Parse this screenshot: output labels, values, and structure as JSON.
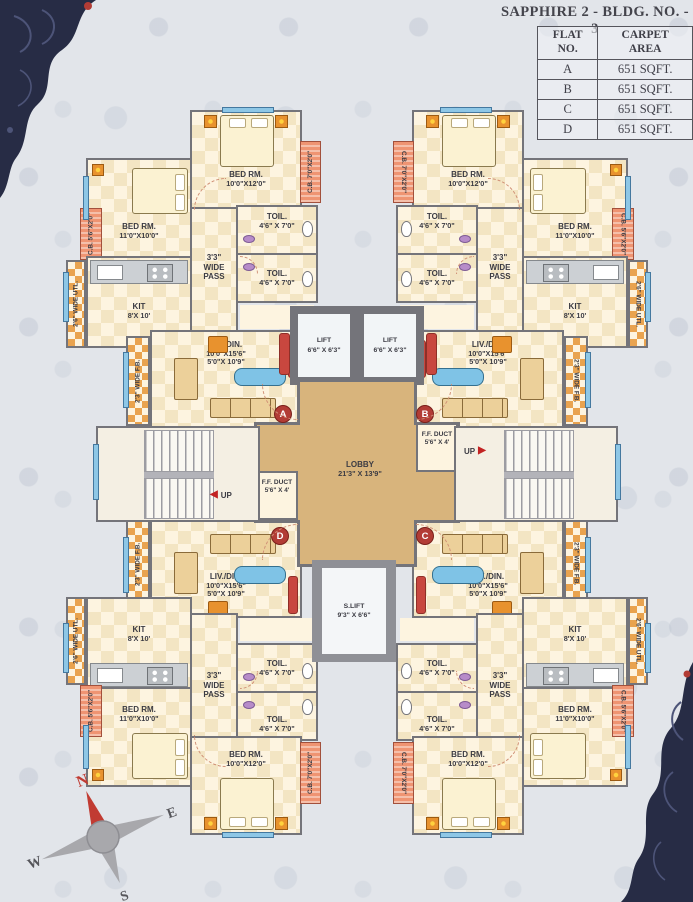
{
  "title": "SAPPHIRE 2 - BLDG. NO. - 3",
  "area_table": {
    "col1_header": "FLAT NO.",
    "col2_header": "CARPET AREA",
    "rows": [
      {
        "flat": "A",
        "area": "651 SQFT."
      },
      {
        "flat": "B",
        "area": "651 SQFT."
      },
      {
        "flat": "C",
        "area": "651 SQFT."
      },
      {
        "flat": "D",
        "area": "651 SQFT."
      }
    ]
  },
  "unit": {
    "bed_top": {
      "name": "BED RM.",
      "dims": "10'0\"X12'0\""
    },
    "bed_side": {
      "name": "BED RM.",
      "dims": "11'0\"X10'0\""
    },
    "kitchen": {
      "name": "KIT",
      "dims": "8'X 10'"
    },
    "toilet": {
      "name": "TOIL.",
      "dims": "4'6\" X 7'0\""
    },
    "living": {
      "name": "LIV./DIN.",
      "dims1": "10'0\"X15'6\"",
      "dims2": "5'0\"X 10'9\""
    },
    "pass": "3'3\" WIDE PASS",
    "flower_bed": "2'3\" WIDE F.B.",
    "utility": "2'6\" WIDE UTL.",
    "cb_side": "C.B. 5'6\"X2'0\"",
    "cb_top": "C.B. 7'0\"X2'0\""
  },
  "core": {
    "lift": {
      "name": "LIFT",
      "dims": "6'6\" X 6'3\""
    },
    "lobby": {
      "name": "LOBBY",
      "dims": "21'3\" X 13'9\""
    },
    "service_lift": {
      "name": "S.LIFT",
      "dims": "9'3\" X 6'6\""
    },
    "duct": {
      "name": "F.F. DUCT",
      "dims": "5'6\" X 4'"
    },
    "up": "UP",
    "markers": {
      "a": "A",
      "b": "B",
      "c": "C",
      "d": "D"
    }
  },
  "compass": {
    "n": "N",
    "e": "E",
    "s": "S",
    "w": "W"
  },
  "colors": {
    "wall": "#74747a",
    "room_fill": "#fdf4e0",
    "checker": "#f3e5c3",
    "lobby_tan": "#d8b47c",
    "salmon": "#ef9472",
    "marker_red": "#b23c35",
    "window_blue": "#8ec7e6",
    "corner_navy": "#272c45"
  }
}
